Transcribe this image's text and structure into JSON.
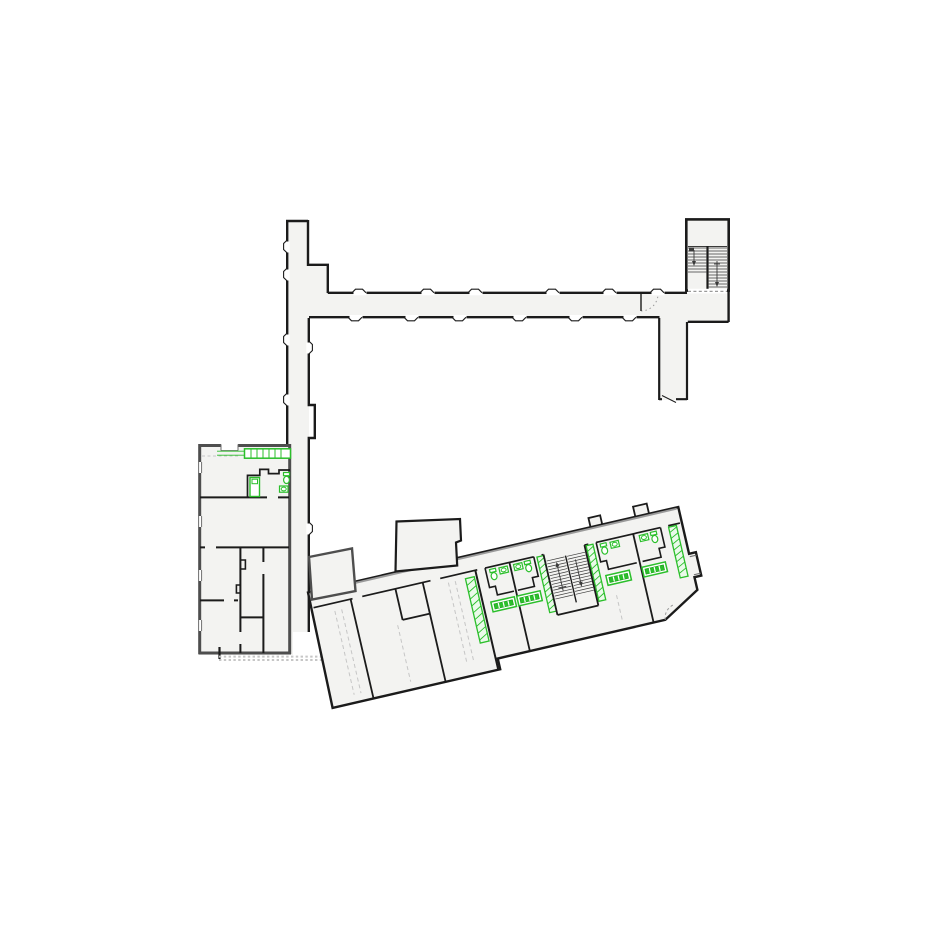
{
  "document": {
    "kind": "architectural-floor-plan",
    "visible_text": "none"
  },
  "colors": {
    "background": "#ffffff",
    "floor_fill": "#f3f3f1",
    "wall_dark": "#1b1b1b",
    "wall_block": "#4e4e4e",
    "wall_gray": "#9a9a9a",
    "fixture_green": "#2bbf2b",
    "fixture_green_dark": "#169916",
    "fixture_green_light": "#eafaea",
    "dash_gray": "#c6c6c6",
    "tread_dark": "#3a3a3a"
  },
  "icons": {
    "toilet": "toilet-icon",
    "sink": "sink-icon",
    "stair_treads": "stair-treads-icon",
    "door_swing": "door-swing-arc-icon",
    "wardrobe_hatch": "wardrobe-hatch-icon",
    "kitchen_counter": "kitchen-counter-icon"
  },
  "counts": {
    "stairwells": 2,
    "toilet_icons": 5,
    "sink_icons": 5,
    "wardrobe_strips": 4,
    "fitted_counters": 4,
    "corridor_door_notches": 12,
    "west_block_window_notches": 4
  },
  "structure": {
    "north_wing": [
      "vertical-corridor",
      "horizontal-corridor",
      "stairwell-north",
      "east-corridor-stub"
    ],
    "west_block": [
      "kitchen-room",
      "kitchen-counter",
      "tall-cabinet",
      "small-bathroom",
      "lower-rooms"
    ],
    "south_wing": [
      "corridor",
      "guest-rooms",
      "bathroom-pods",
      "stairwell-south",
      "wardrobes",
      "counters"
    ]
  }
}
